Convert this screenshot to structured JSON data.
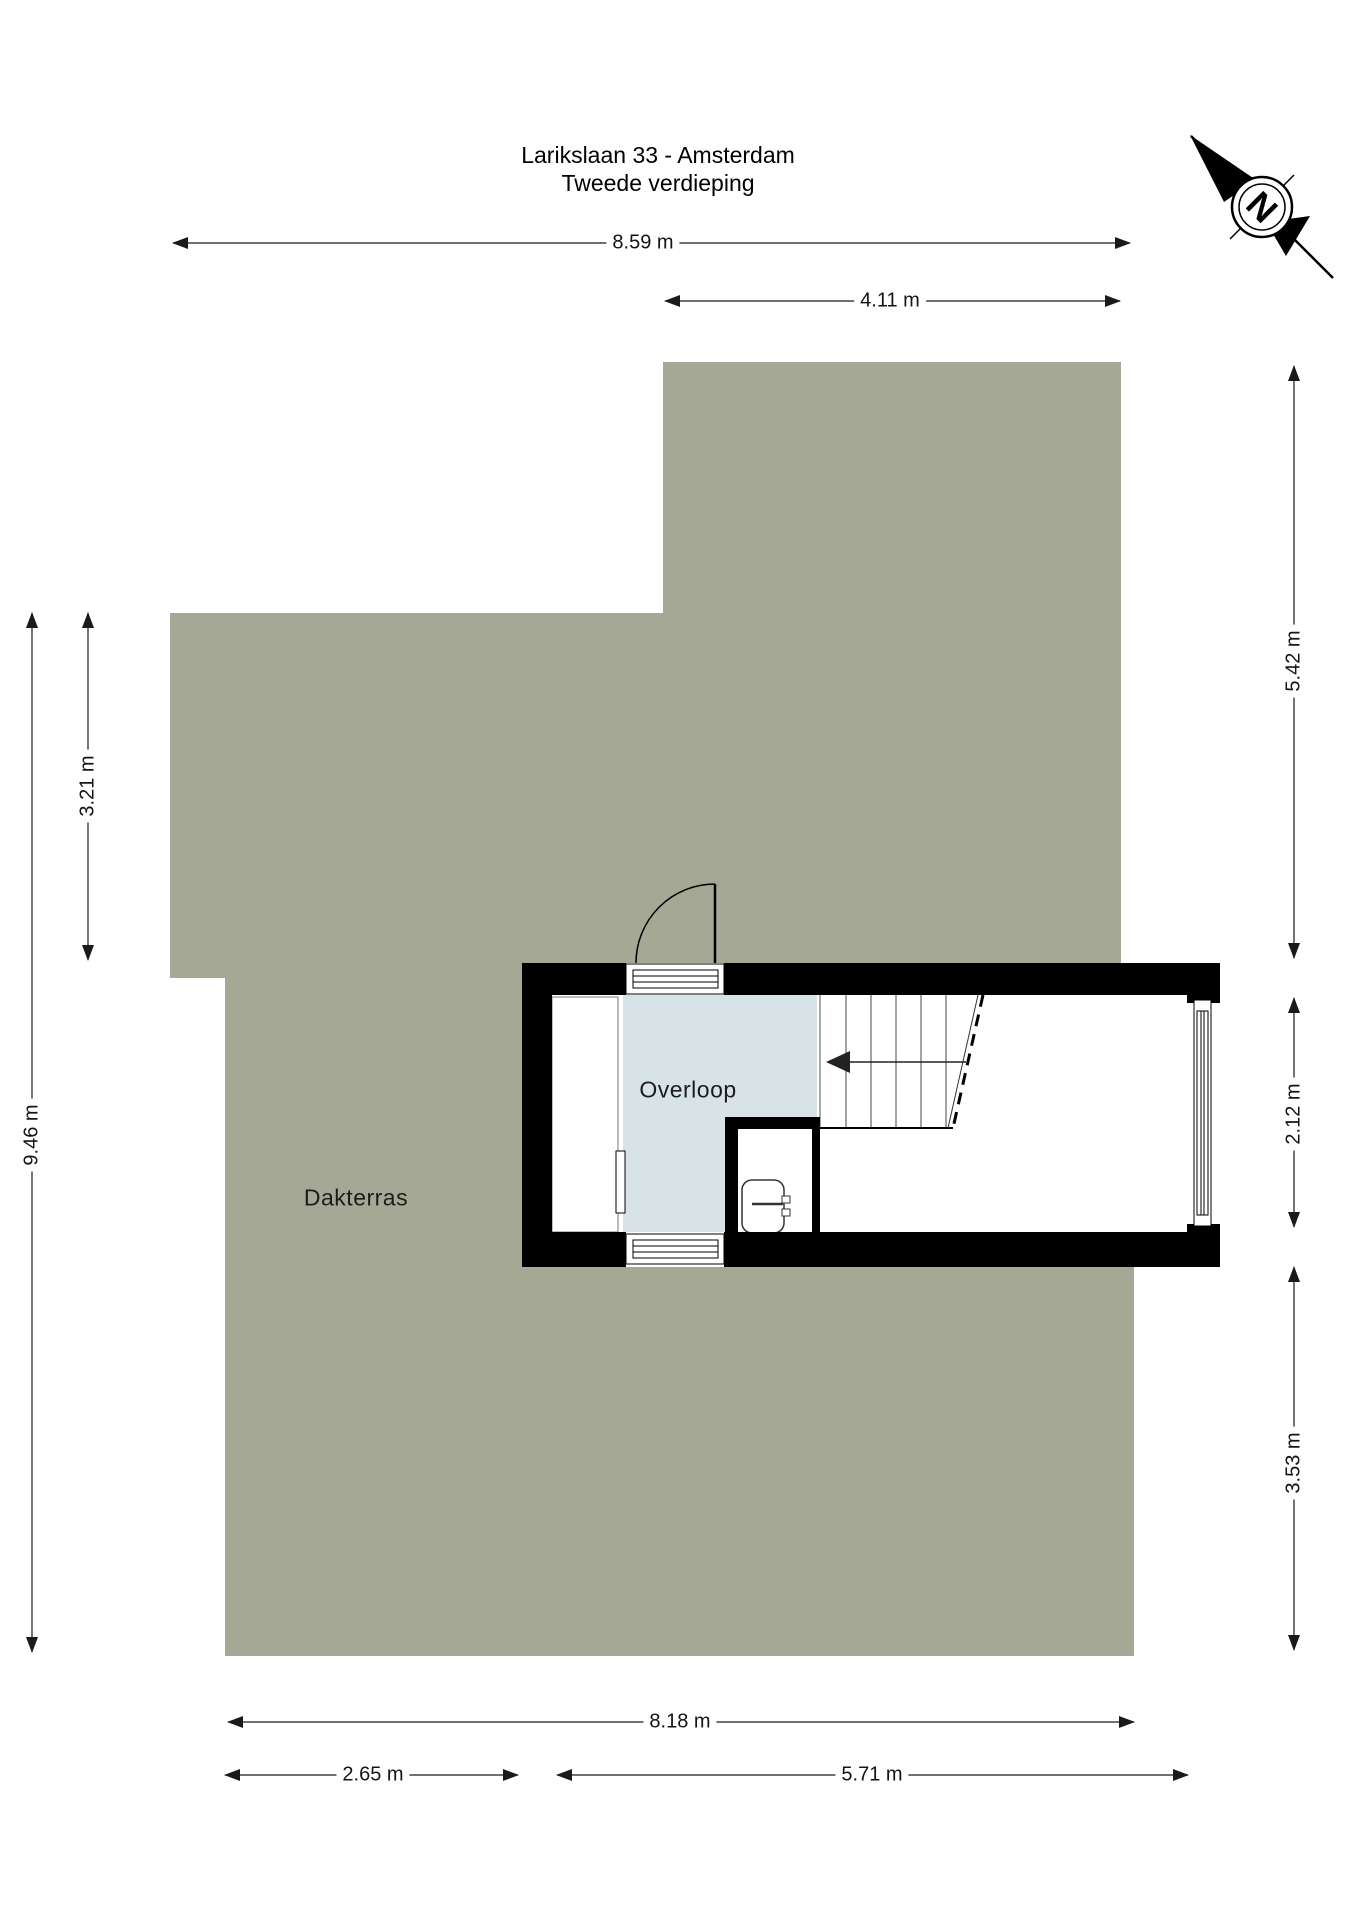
{
  "header": {
    "title_line1": "Larikslaan 33 - Amsterdam",
    "title_line2": "Tweede verdieping"
  },
  "compass": {
    "letter": "N"
  },
  "plan": {
    "terrace_label": "Dakterras",
    "landing_label": "Overloop",
    "dimensions": {
      "top_total": "8.59 m",
      "top_building": "4.11 m",
      "right_terrace_upper": "5.42 m",
      "right_building_inner": "2.12 m",
      "right_terrace_lower": "3.53 m",
      "left_terrace_upper": "3.21 m",
      "left_total": "9.46 m",
      "bottom_total": "8.18 m",
      "bottom_terrace_left": "2.65 m",
      "bottom_building_inner": "5.71 m"
    }
  },
  "colors": {
    "terrace": "#a6a896",
    "landing": "#d7e3e7",
    "wall": "#000000",
    "paper": "#ffffff",
    "dimension": "#1a1a1a"
  }
}
